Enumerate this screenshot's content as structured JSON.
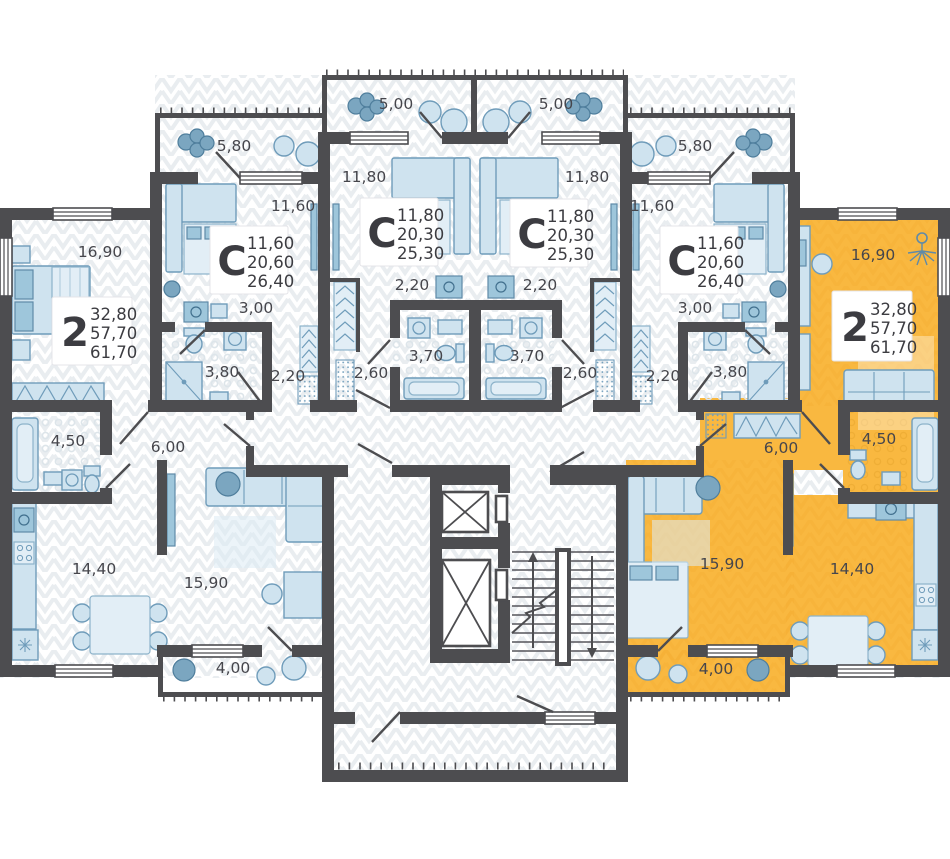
{
  "palette": {
    "highlight": "#f9b840",
    "wall": "#4d4d50",
    "furniture_fill": "#cfe3ef",
    "furniture_stroke": "#6f9cba",
    "label_text": "#46464c",
    "floor_pattern": "#e9edf0"
  },
  "units": [
    {
      "id": "apt-2-left",
      "highlighted": false,
      "card": {
        "label": "2",
        "values": [
          "32,80",
          "57,70",
          "61,70"
        ]
      },
      "rooms": {
        "bedroom": "16,90",
        "bath": "4,50",
        "hall": "6,00",
        "kitchen": "14,40",
        "living": "15,90",
        "balcony": "4,00"
      }
    },
    {
      "id": "studio-left",
      "highlighted": false,
      "card": {
        "label": "С",
        "values": [
          "11,60",
          "20,60",
          "26,40"
        ]
      },
      "rooms": {
        "balcony": "5,80",
        "room": "11,60",
        "hall": "3,00",
        "bath": "3,80",
        "wardrobe": "2,20"
      }
    },
    {
      "id": "studio-mid-left",
      "highlighted": false,
      "card": {
        "label": "С",
        "values": [
          "11,80",
          "20,30",
          "25,30"
        ]
      },
      "rooms": {
        "balcony": "5,00",
        "room": "11,80",
        "hall": "2,20",
        "bath": "3,70",
        "wardrobe": "2,60"
      }
    },
    {
      "id": "studio-mid-right",
      "highlighted": false,
      "card": {
        "label": "С",
        "values": [
          "11,80",
          "20,30",
          "25,30"
        ]
      },
      "rooms": {
        "balcony": "5,00",
        "room": "11,80",
        "hall": "2,20",
        "bath": "3,70",
        "wardrobe": "2,60"
      }
    },
    {
      "id": "studio-right",
      "highlighted": false,
      "card": {
        "label": "С",
        "values": [
          "11,60",
          "20,60",
          "26,40"
        ]
      },
      "rooms": {
        "balcony": "5,80",
        "room": "11,60",
        "hall": "3,00",
        "bath": "3,80",
        "wardrobe": "2,20"
      }
    },
    {
      "id": "apt-2-right",
      "highlighted": true,
      "card": {
        "label": "2",
        "values": [
          "32,80",
          "57,70",
          "61,70"
        ]
      },
      "rooms": {
        "bedroom": "16,90",
        "bath": "4,50",
        "hall": "6,00",
        "kitchen": "14,40",
        "living": "15,90",
        "balcony": "4,00"
      }
    }
  ]
}
